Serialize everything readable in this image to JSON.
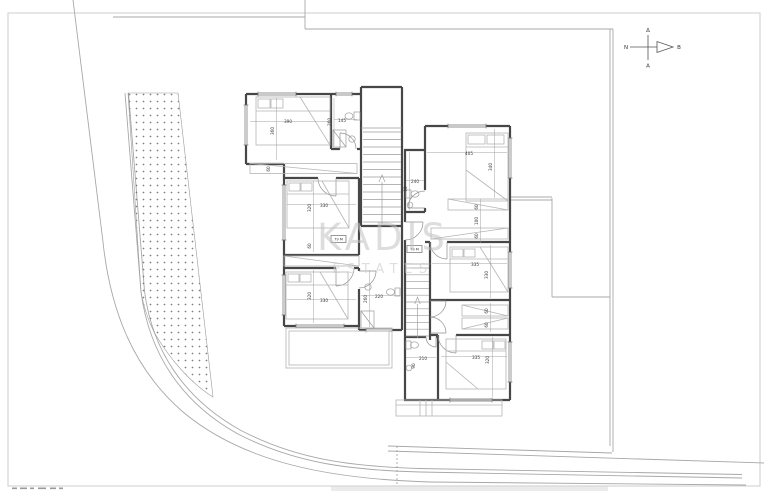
{
  "watermark": {
    "title": "KADIS",
    "subtitle": "ESTATES"
  },
  "compass": {
    "north": "Β",
    "south": "Ν",
    "west": "Δ",
    "east": "Α"
  },
  "badges": [
    {
      "label": "79 M"
    },
    {
      "label": "79 M"
    }
  ],
  "plan": {
    "type": "floor-plan",
    "dimensions": [
      {
        "text": "390",
        "x": 288,
        "y": 123
      },
      {
        "text": "360",
        "x": 274,
        "y": 131,
        "vertical": true
      },
      {
        "text": "260",
        "x": 331,
        "y": 122,
        "vertical": true
      },
      {
        "text": "145",
        "x": 342,
        "y": 122
      },
      {
        "text": "60",
        "x": 270,
        "y": 169,
        "vertical": true
      },
      {
        "text": "330",
        "x": 324,
        "y": 207
      },
      {
        "text": "320",
        "x": 311,
        "y": 208,
        "vertical": true
      },
      {
        "text": "60",
        "x": 311,
        "y": 246,
        "vertical": true
      },
      {
        "text": "330",
        "x": 324,
        "y": 302
      },
      {
        "text": "320",
        "x": 311,
        "y": 296,
        "vertical": true
      },
      {
        "text": "220",
        "x": 379,
        "y": 298
      },
      {
        "text": "260",
        "x": 367,
        "y": 299,
        "vertical": true
      },
      {
        "text": "240",
        "x": 415,
        "y": 183
      },
      {
        "text": "90",
        "x": 407,
        "y": 189,
        "vertical": true
      },
      {
        "text": "405",
        "x": 469,
        "y": 155
      },
      {
        "text": "340",
        "x": 492,
        "y": 167,
        "vertical": true
      },
      {
        "text": "60",
        "x": 478,
        "y": 207,
        "vertical": true
      },
      {
        "text": "100",
        "x": 478,
        "y": 221,
        "vertical": true
      },
      {
        "text": "60",
        "x": 478,
        "y": 236,
        "vertical": true
      },
      {
        "text": "335",
        "x": 475,
        "y": 266
      },
      {
        "text": "330",
        "x": 488,
        "y": 275,
        "vertical": true
      },
      {
        "text": "60",
        "x": 488,
        "y": 311,
        "vertical": true
      },
      {
        "text": "60",
        "x": 488,
        "y": 325,
        "vertical": true
      },
      {
        "text": "335",
        "x": 476,
        "y": 359
      },
      {
        "text": "320",
        "x": 489,
        "y": 360,
        "vertical": true
      },
      {
        "text": "210",
        "x": 423,
        "y": 360
      },
      {
        "text": "90",
        "x": 415,
        "y": 366,
        "vertical": true
      }
    ]
  }
}
